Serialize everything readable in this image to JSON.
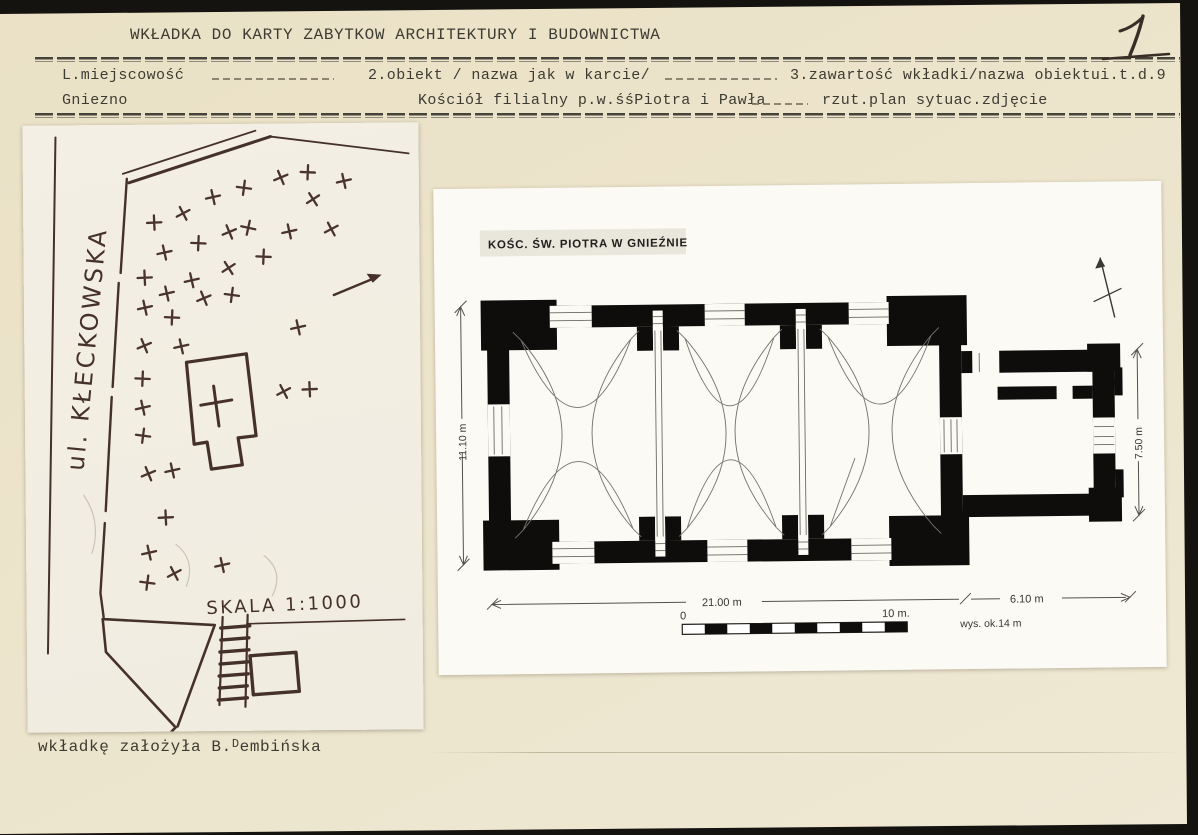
{
  "header": {
    "title": "WKŁADKA DO KARTY ZABYTKOW ARCHITEKTURY I BUDOWNICTWA",
    "page_number": "1"
  },
  "fields": {
    "loc_label": "L.miejscowość",
    "loc_value": "Gniezno",
    "obj_label": "2.obiekt / nazwa jak w karcie/",
    "obj_value": "Kościół filialny p.w.śśPiotra i Pawła",
    "content_label": "3.zawartość wkładki/nazwa obiektui.t.d.9",
    "content_value": "rzut.plan sytuac.zdjęcie"
  },
  "footer": {
    "prefix": "wkładkę założyła B.",
    "superscript": "D",
    "suffix": "embińska"
  },
  "site_sketch": {
    "street_label": "ul. KŁECKOWSKA",
    "scale_label": "SKALA 1:1000",
    "crosses": [
      [
        131,
        98,
        10
      ],
      [
        160,
        89,
        -15
      ],
      [
        190,
        73,
        0
      ],
      [
        221,
        64,
        20
      ],
      [
        258,
        54,
        -10
      ],
      [
        285,
        49,
        15
      ],
      [
        321,
        58,
        0
      ],
      [
        290,
        76,
        -20
      ],
      [
        141,
        128,
        0
      ],
      [
        175,
        119,
        15
      ],
      [
        206,
        108,
        -10
      ],
      [
        225,
        104,
        25
      ],
      [
        266,
        108,
        0
      ],
      [
        308,
        106,
        -15
      ],
      [
        121,
        153,
        10
      ],
      [
        168,
        156,
        0
      ],
      [
        205,
        144,
        -20
      ],
      [
        240,
        133,
        15
      ],
      [
        143,
        169,
        0
      ],
      [
        180,
        174,
        -10
      ],
      [
        208,
        171,
        20
      ],
      [
        121,
        183,
        0
      ],
      [
        148,
        193,
        15
      ],
      [
        120,
        221,
        -10
      ],
      [
        274,
        204,
        0
      ],
      [
        118,
        254,
        15
      ],
      [
        259,
        268,
        -15
      ],
      [
        285,
        266,
        10
      ],
      [
        118,
        283,
        0
      ],
      [
        118,
        311,
        20
      ],
      [
        123,
        349,
        -10
      ],
      [
        147,
        346,
        0
      ],
      [
        140,
        393,
        10
      ],
      [
        123,
        428,
        0
      ],
      [
        148,
        449,
        -15
      ],
      [
        121,
        458,
        20
      ],
      [
        196,
        441,
        0
      ],
      [
        157,
        222,
        0
      ]
    ]
  },
  "floor_plan": {
    "title": "KOŚC. ŚW. PIOTRA W GNIEŹNIE",
    "dim_nave_width": "11.10 m",
    "dim_chancel_width": "7.50 m",
    "dim_nave_length": "21.00 m",
    "dim_chancel_length": "6.10 m",
    "scale_zero": "0",
    "scale_ten": "10 m.",
    "height_note": "wys. ok.14 m"
  },
  "colors": {
    "page": "#ece4cb",
    "typed_ink": "#3d3b32",
    "hand_ink": "#46312a",
    "plan_black": "#0e0d0b",
    "photo_paper": "#f2eee2",
    "plan_paper": "#fbfaf4"
  }
}
